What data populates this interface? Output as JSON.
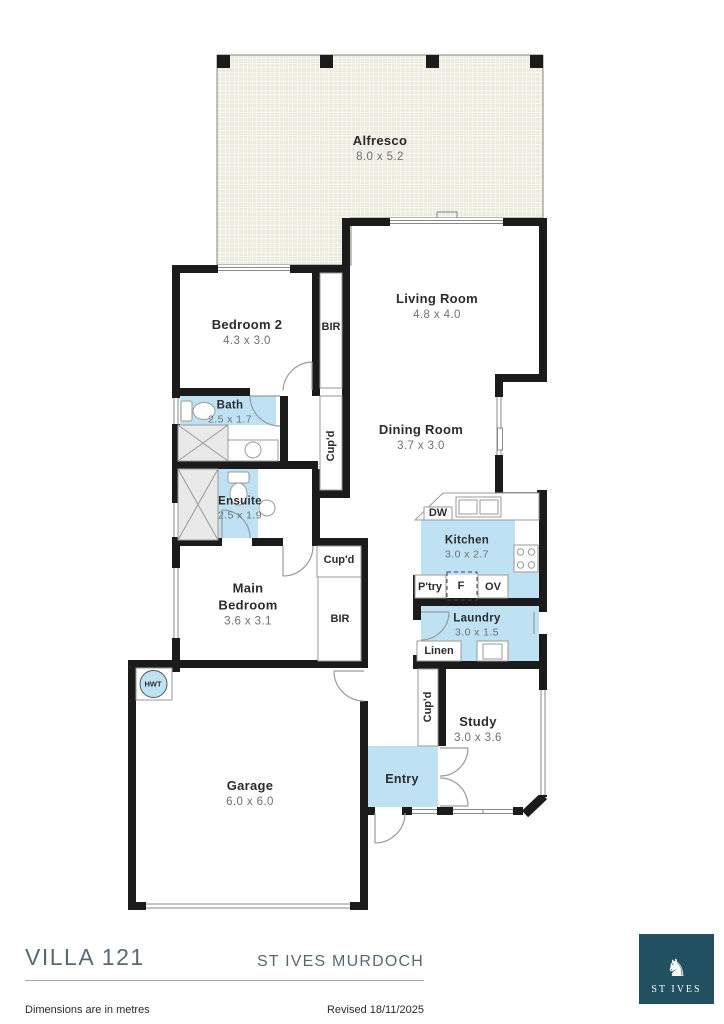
{
  "colors": {
    "accent_blue": "#bee2f3",
    "wall_black": "#1b1b1b",
    "alfresco_fill": "#ececdf",
    "logo_teal": "#215061",
    "footer_gray": "#5a6872"
  },
  "rooms": {
    "alfresco": {
      "name": "Alfresco",
      "dims": "8.0 x 5.2"
    },
    "living": {
      "name": "Living Room",
      "dims": "4.8 x 4.0"
    },
    "bedroom2": {
      "name": "Bedroom 2",
      "dims": "4.3 x 3.0"
    },
    "dining": {
      "name": "Dining Room",
      "dims": "3.7 x 3.0"
    },
    "bath": {
      "name": "Bath",
      "dims": "2.5 x 1.7"
    },
    "ensuite": {
      "name": "Ensuite",
      "dims": "2.5 x 1.9"
    },
    "kitchen": {
      "name": "Kitchen",
      "dims": "3.0 x 2.7"
    },
    "main_bedroom": {
      "line1": "Main",
      "line2": "Bedroom",
      "dims": "3.6 x 3.1"
    },
    "laundry": {
      "name": "Laundry",
      "dims": "3.0 x 1.5"
    },
    "study": {
      "name": "Study",
      "dims": "3.0 x 3.6"
    },
    "garage": {
      "name": "Garage",
      "dims": "6.0 x 6.0"
    },
    "entry": {
      "name": "Entry"
    }
  },
  "fixtures": {
    "bir_bed2": "BIR",
    "cupd_hall": "Cup'd",
    "cupd_main": "Cup'd",
    "bir_main": "BIR",
    "dw": "DW",
    "ptry": "P'try",
    "fridge": "F",
    "oven": "OV",
    "linen": "Linen",
    "hwt": "HWT",
    "cupd_study": "Cup'd"
  },
  "footer": {
    "plan_title": "VILLA 121",
    "estate": "ST IVES MURDOCH",
    "note": "Dimensions are in metres",
    "revised": "Revised 18/11/2025",
    "logo_text": "ST IVES"
  }
}
